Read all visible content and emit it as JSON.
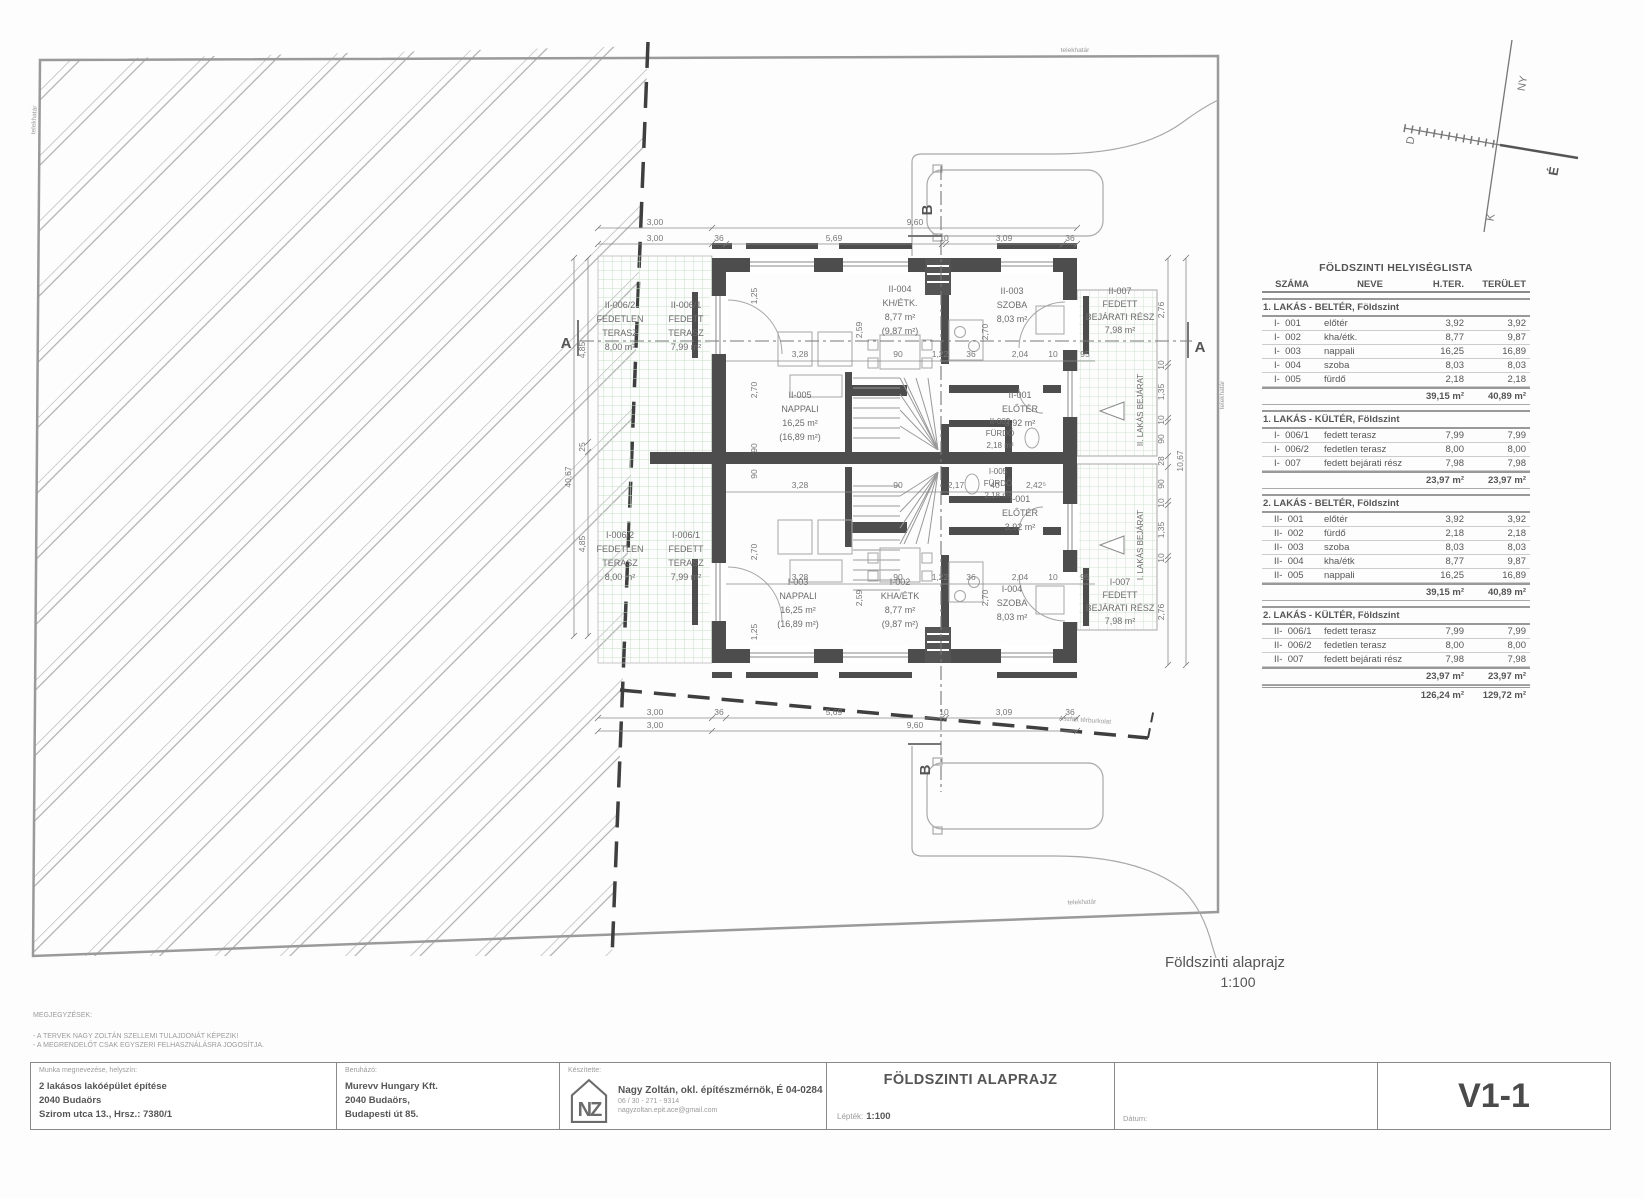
{
  "site": {
    "boundary_label": "telekhatár",
    "pavement_label": "Aszfalt térburkolat"
  },
  "compass": {
    "n": "É",
    "e": "K",
    "s": "D",
    "w": "NY"
  },
  "sections": {
    "a": "A",
    "b": "B"
  },
  "plan": {
    "rooms": [
      [
        "II-006/2",
        "FEDETLEN",
        "TERASZ",
        "8,00 m²"
      ],
      [
        "II-006/1",
        "FEDETT",
        "TERASZ",
        "7,99 m²"
      ],
      [
        "II-005",
        "NAPPALI",
        "16,25 m²",
        "(16,89 m²)"
      ],
      [
        "II-004",
        "KH/ÉTK.",
        "8,77 m²",
        "(9,87 m²)"
      ],
      [
        "II-003",
        "SZOBA",
        "8,03 m²"
      ],
      [
        "II-001",
        "ELŐTÉR",
        "3,92 m²"
      ],
      [
        "II-002",
        "FÜRDŐ",
        "2,18 m²"
      ],
      [
        "II-007",
        "FEDETT",
        "BEJÁRATI RÉSZ",
        "7,98 m²"
      ],
      [
        "I-006/2",
        "FEDETLEN",
        "TERASZ",
        "8,00 m²"
      ],
      [
        "I-006/1",
        "FEDETT",
        "TERASZ",
        "7,99 m²"
      ],
      [
        "I-001",
        "ELŐTÉR",
        "3,92 m²"
      ],
      [
        "I-005",
        "FÜRDŐ",
        "2,18 m²"
      ],
      [
        "I-002",
        "KHA/ÉTK",
        "8,77 m²",
        "(9,87 m²)"
      ],
      [
        "I-003",
        "NAPPALI",
        "16,25 m²",
        "(16,89 m²)"
      ],
      [
        "I-004",
        "SZOBA",
        "8,03 m²"
      ],
      [
        "I-007",
        "FEDETT",
        "BEJÁRATI RÉSZ",
        "7,98 m²"
      ]
    ],
    "entrances": [
      "II. LAKÁS BEJÁRAT",
      "I. LAKÁS BEJÁRAT"
    ],
    "dims": {
      "top_overall": [
        "3,00",
        "9,60"
      ],
      "top_detail": [
        "3,00",
        "36",
        "5,69",
        "10",
        "3,09",
        "36"
      ],
      "mid_row_a": [
        "3,28",
        "90",
        "1,22",
        "36",
        "2,04",
        "10",
        "95"
      ],
      "mid_row_b": [
        "3,28",
        "90",
        "2,17",
        "40",
        "2,42⁵"
      ],
      "mid_row_c": [
        "3,28",
        "90",
        "1,22",
        "36",
        "2,04",
        "10",
        "95"
      ],
      "bottom_detail": [
        "3,00",
        "36",
        "5,69",
        "10",
        "3,09",
        "36"
      ],
      "bottom_overall": [
        "3,00",
        "9,60"
      ],
      "right_detail": [
        "2,76",
        "10",
        "1,35",
        "10",
        "90",
        "28",
        "90",
        "10",
        "1,35",
        "10",
        "2,76"
      ],
      "right_overall": "10,67",
      "left_detail": [
        "4,85",
        "25",
        "4,85"
      ],
      "left_overall": "40,67",
      "v_dims": [
        "1,25",
        "2,70",
        "2,59",
        "2,70",
        "90",
        "90",
        "2,59",
        "2,70",
        "2,70",
        "1,25"
      ]
    }
  },
  "legend": {
    "line1": "Földszinti alaprajz",
    "line2": "1:100"
  },
  "table": {
    "title": "FÖLDSZINTI HELYISÉGLISTA",
    "col_szama": "SZÁMA",
    "col_neve": "NEVE",
    "col_hter": "H.TER.",
    "col_terulet": "TERÜLET",
    "sections": [
      {
        "heading": "1. LAKÁS - BELTÉR, Földszint",
        "rows": [
          {
            "num": "I-  001",
            "name": "előtér",
            "hter": "3,92",
            "ter": "3,92"
          },
          {
            "num": "I-  002",
            "name": "kha/étk.",
            "hter": "8,77",
            "ter": "9,87"
          },
          {
            "num": "I-  003",
            "name": "nappali",
            "hter": "16,25",
            "ter": "16,89"
          },
          {
            "num": "I-  004",
            "name": "szoba",
            "hter": "8,03",
            "ter": "8,03"
          },
          {
            "num": "I-  005",
            "name": "fürdő",
            "hter": "2,18",
            "ter": "2,18"
          }
        ],
        "sub_hter": "39,15 m²",
        "sub_ter": "40,89 m²"
      },
      {
        "heading": "1. LAKÁS - KÜLTÉR, Földszint",
        "rows": [
          {
            "num": "I-  006/1",
            "name": "fedett terasz",
            "hter": "7,99",
            "ter": "7,99"
          },
          {
            "num": "I-  006/2",
            "name": "fedetlen terasz",
            "hter": "8,00",
            "ter": "8,00"
          },
          {
            "num": "I-  007",
            "name": "fedett bejárati rész",
            "hter": "7,98",
            "ter": "7,98"
          }
        ],
        "sub_hter": "23,97 m²",
        "sub_ter": "23,97 m²"
      },
      {
        "heading": "2. LAKÁS - BELTÉR, Földszint",
        "rows": [
          {
            "num": "II-  001",
            "name": "előtér",
            "hter": "3,92",
            "ter": "3,92"
          },
          {
            "num": "II-  002",
            "name": "fürdő",
            "hter": "2,18",
            "ter": "2,18"
          },
          {
            "num": "II-  003",
            "name": "szoba",
            "hter": "8,03",
            "ter": "8,03"
          },
          {
            "num": "II-  004",
            "name": "kha/étk",
            "hter": "8,77",
            "ter": "9,87"
          },
          {
            "num": "II-  005",
            "name": "nappali",
            "hter": "16,25",
            "ter": "16,89"
          }
        ],
        "sub_hter": "39,15 m²",
        "sub_ter": "40,89 m²"
      },
      {
        "heading": "2. LAKÁS - KÜLTÉR, Földszint",
        "rows": [
          {
            "num": "II-  006/1",
            "name": "fedett terasz",
            "hter": "7,99",
            "ter": "7,99"
          },
          {
            "num": "II-  006/2",
            "name": "fedetlen terasz",
            "hter": "8,00",
            "ter": "8,00"
          },
          {
            "num": "II-  007",
            "name": "fedett bejárati rész",
            "hter": "7,98",
            "ter": "7,98"
          }
        ],
        "sub_hter": "23,97 m²",
        "sub_ter": "23,97 m²"
      }
    ],
    "total_hter": "126,24 m²",
    "total_ter": "129,72 m²"
  },
  "notes": {
    "heading": "MEGJEGYZÉSEK:",
    "lines": [
      "- A TERVEK NAGY ZOLTÁN SZELLEMI TULAJDONÁT KÉPEZIK!",
      "- A MEGRENDELŐT CSAK EGYSZERI FELHASZNÁLÁSRA JOGOSÍTJA."
    ]
  },
  "titleblock": {
    "col1_label": "Munka megnevezése, helyszín:",
    "col1_lines": [
      "2 lakásos lakóépület építése",
      "2040 Budaörs",
      "Szirom utca 13., Hrsz.: 7380/1"
    ],
    "col2_label": "Beruházó:",
    "col2_lines": [
      "Murevv Hungary Kft.",
      "2040 Budaörs,",
      "Budapesti út 85."
    ],
    "col3_label": "Készítette:",
    "logo_text": "NZ",
    "architect": "Nagy Zoltán, okl. építészmérnök, É 04-0284",
    "phone": "06 / 30 - 271 - 9314",
    "email": "nagyzoltan.epit.ace@gmail.com",
    "drawing_title": "FÖLDSZINTI ALAPRAJZ",
    "scale_label": "Lépték:",
    "scale_value": "1:100",
    "date_label": "Dátum:",
    "sheet_number": "V1-1"
  }
}
